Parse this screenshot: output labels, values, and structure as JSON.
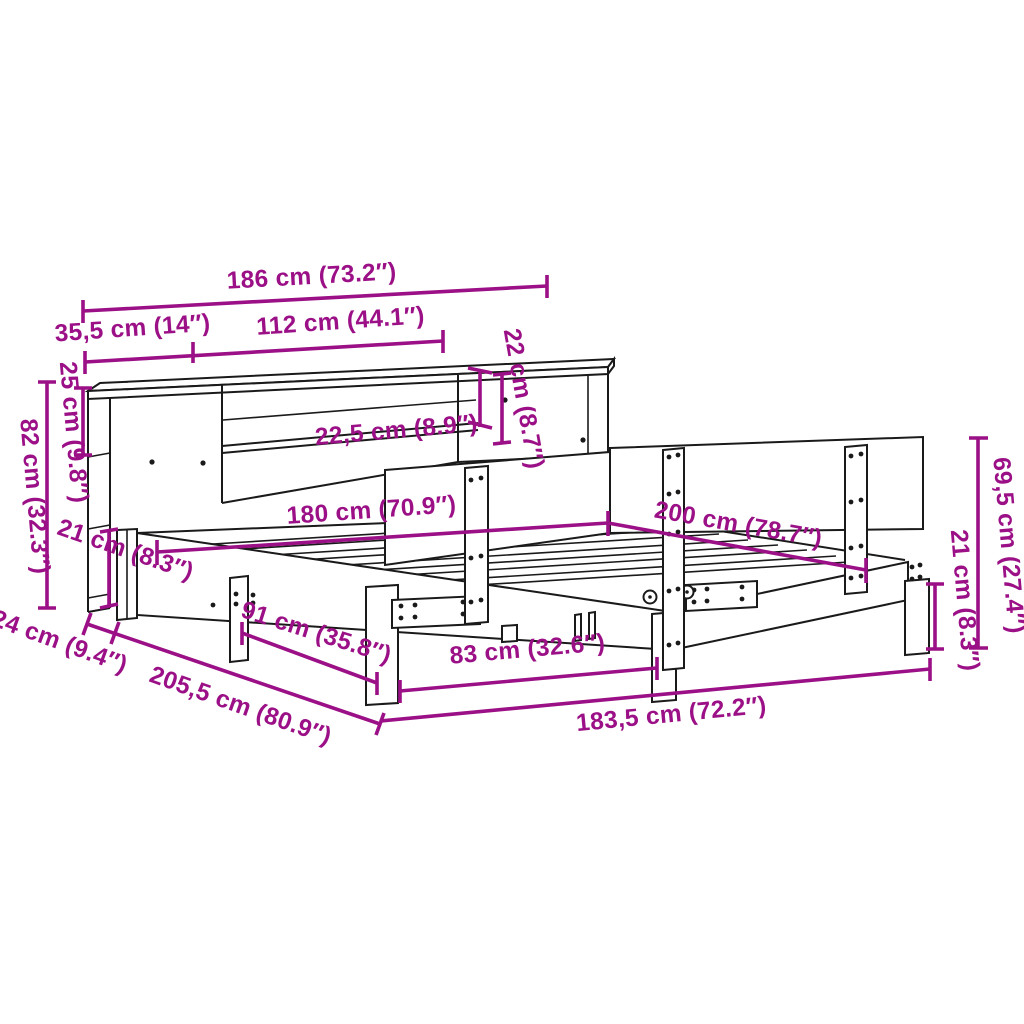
{
  "diagram": {
    "type": "furniture-dimension-diagram",
    "subject": "bed frame with bookcase headboard",
    "colors": {
      "background": "#FFFFFF",
      "line_art": "#1A1A1A",
      "dimension_accent": "#9B1086"
    },
    "units": [
      "cm",
      "inches"
    ],
    "dimensions": [
      {
        "id": "overall-width",
        "label": "186 cm (73.2″)"
      },
      {
        "id": "left-section-width",
        "label": "35,5 cm (14″)"
      },
      {
        "id": "center-section-width",
        "label": "112 cm (44.1″)"
      },
      {
        "id": "shelf-compartment-height",
        "label": "22 cm (8.7″)"
      },
      {
        "id": "shelf-depth",
        "label": "22,5 cm (8.9″)"
      },
      {
        "id": "cubby-height",
        "label": "25 cm (9.8″)"
      },
      {
        "id": "headboard-total-height",
        "label": "82 cm (32.3″)"
      },
      {
        "id": "frame-height-left",
        "label": "21 cm (8.3″)"
      },
      {
        "id": "bed-width",
        "label": "180 cm (70.9″)"
      },
      {
        "id": "bed-length",
        "label": "200 cm (78.7″)"
      },
      {
        "id": "panel-height",
        "label": "69,5 cm (27.4″)"
      },
      {
        "id": "leg-height",
        "label": "21 cm (8.3″)"
      },
      {
        "id": "base-depth",
        "label": "24 cm (9.4″)"
      },
      {
        "id": "overall-length",
        "label": "205,5 cm (80.9″)"
      },
      {
        "id": "leg-spacing",
        "label": "91 cm (35.8″)"
      },
      {
        "id": "slat-span",
        "label": "83 cm (32.6″)"
      },
      {
        "id": "frame-length",
        "label": "183,5 cm (72.2″)"
      }
    ]
  }
}
